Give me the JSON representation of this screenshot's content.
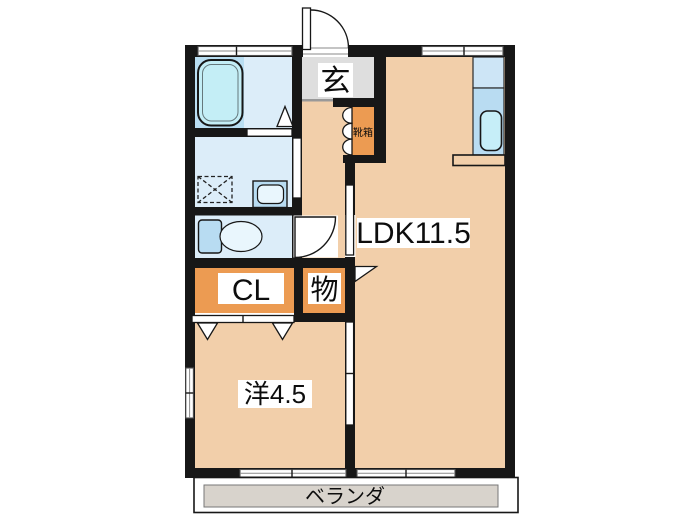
{
  "plan": {
    "type": "apartment-floor-plan",
    "labels": {
      "ldk": "LDK11.5",
      "western_room": "洋4.5",
      "closet": "CL",
      "storage": "物",
      "entrance": "玄",
      "shoe_cabinet": "靴箱",
      "veranda": "ベランダ"
    },
    "colors": {
      "wall": "#171717",
      "floor": "#f2cfaa",
      "storage_orange": "#ec9b52",
      "wet_room": "#dcedf9",
      "bath_panel": "#b9def2",
      "bathtub": "#c4eef6",
      "kitchen": "#b9dcf2",
      "entrance_gray": "#dedede",
      "veranda_gray": "#d8d3cc"
    }
  }
}
